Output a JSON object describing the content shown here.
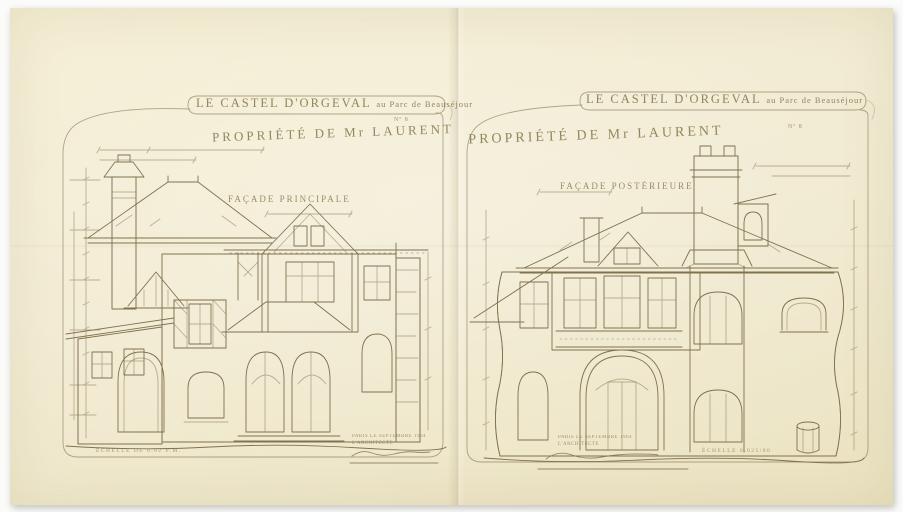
{
  "colors": {
    "paper": "#f1ead0",
    "ink": "#8a7b52"
  },
  "sheets": [
    {
      "title": "LE CASTEL D'ORGEVAL",
      "title_tail": "au Parc de Beauséjour",
      "plate": "Nº 8",
      "owner": "PROPRIÉTÉ DE Mr LAURENT",
      "facade_label": "FAÇADE PRINCIPALE",
      "signature_place_date": "PARIS LE SEPTEMBRE 1904",
      "signature_role": "L'ARCHITECTE",
      "scale_note": "ÉCHELLE DE 0.02 P.M."
    },
    {
      "title": "LE CASTEL D'ORGEVAL",
      "title_tail": "au Parc de Beauséjour",
      "plate": "Nº 8",
      "owner": "PROPRIÉTÉ DE Mr LAURENT",
      "facade_label": "FAÇADE POSTÉRIEURE",
      "signature_place_date": "PARIS LE SEPTEMBRE 1904",
      "signature_role": "L'ARCHITECTE",
      "scale_note": "ÉCHELLE 0.025/00"
    }
  ]
}
